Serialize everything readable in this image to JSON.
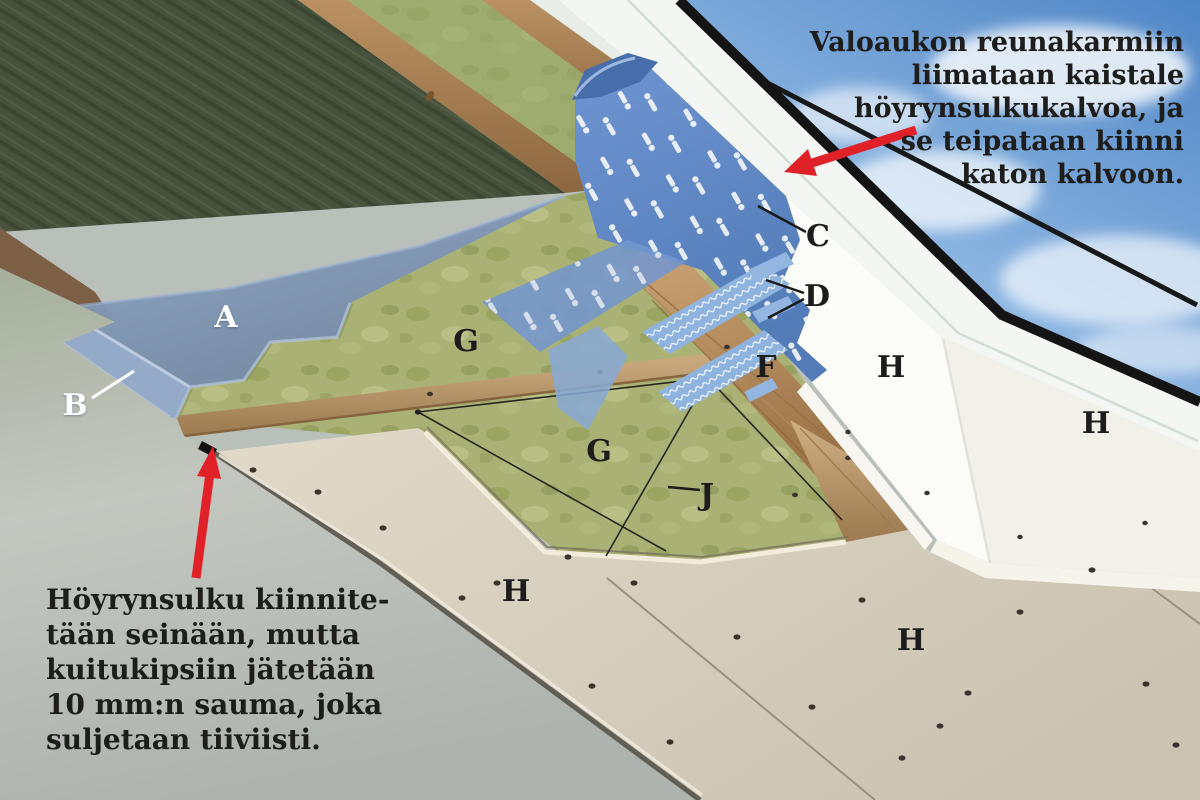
{
  "annotations": {
    "top_right": {
      "lines": [
        "Valoaukon reunakarmiin",
        "liimataan kaistale",
        "höyrynsulkukalvoa, ja",
        "se teipataan kiinni",
        "katon kalvoon."
      ]
    },
    "bottom_left": {
      "lines": [
        "Höyrynsulku kiinnite-",
        "tään seinään, mutta",
        "kuitukipsiin jätetään",
        "10 mm:n sauma, joka",
        "suljetaan tiiviisti."
      ]
    }
  },
  "labels": [
    {
      "letter": "A",
      "tone": "light"
    },
    {
      "letter": "B",
      "tone": "light"
    },
    {
      "letter": "C",
      "tone": "dark"
    },
    {
      "letter": "D",
      "tone": "dark"
    },
    {
      "letter": "F",
      "tone": "dark"
    },
    {
      "letter": "G",
      "tone": "dark"
    },
    {
      "letter": "G",
      "tone": "dark"
    },
    {
      "letter": "H",
      "tone": "dark"
    },
    {
      "letter": "H",
      "tone": "dark"
    },
    {
      "letter": "H",
      "tone": "dark"
    },
    {
      "letter": "H",
      "tone": "dark"
    },
    {
      "letter": "J",
      "tone": "dark"
    }
  ],
  "colors": {
    "arrow_red": "#e02128",
    "printed_membrane_blue": "#5f87c6",
    "vapour_barrier_blue_gray": "#8199bc",
    "insulation_light_green": "#a9b174",
    "insulation_dark_green": "#46523b",
    "gypsum_ceiling_beige": "#d8d1c0",
    "shaft_wall_white": "#fbfbf8",
    "sky_blue": "#5a90cc",
    "wood_brown": "#b98f60",
    "text_dark": "#1d1d1b",
    "label_light": "#ffffff"
  }
}
